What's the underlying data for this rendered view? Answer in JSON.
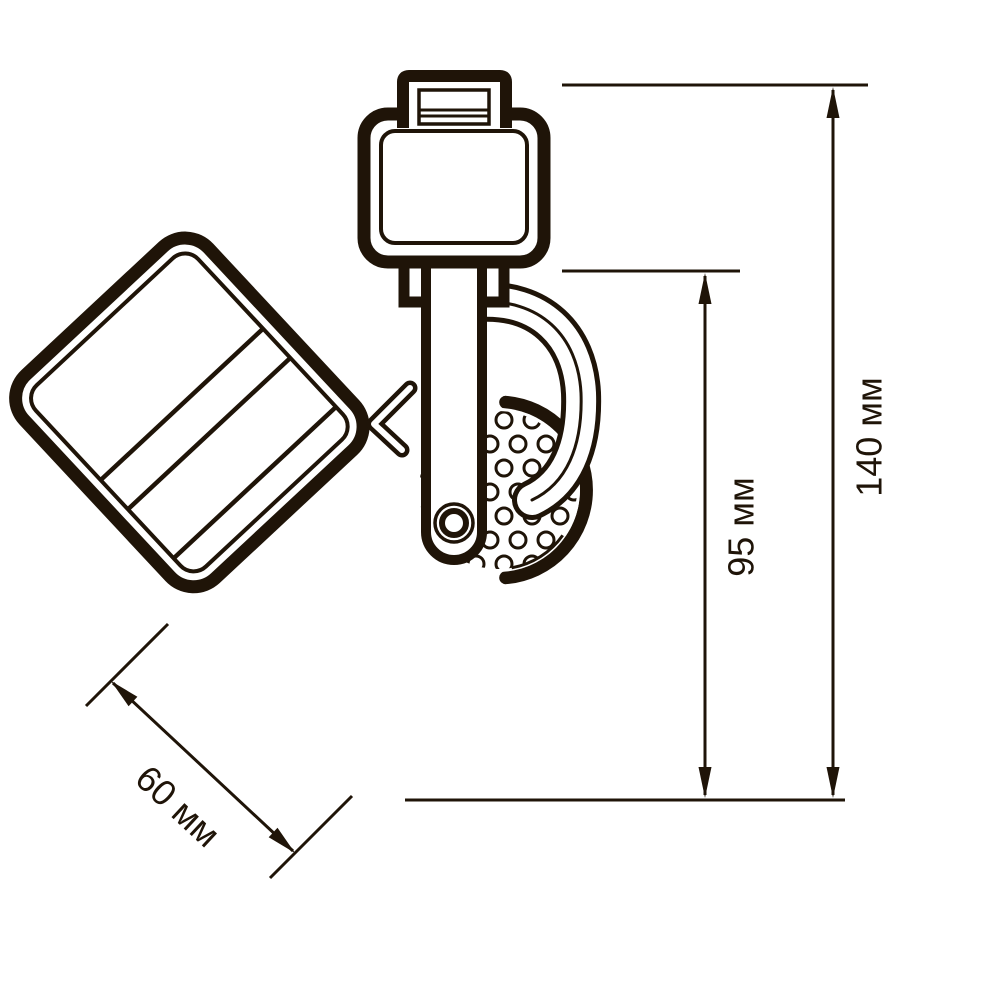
{
  "diagram": {
    "type": "technical-dimension-drawing",
    "subject": "track spotlight fixture, side view",
    "ink_color": "#1f1408",
    "background_color": "#ffffff",
    "dimensions": [
      {
        "id": "total-height",
        "label": "140 мм",
        "value": 140,
        "unit": "мм",
        "orientation": "vertical"
      },
      {
        "id": "body-height",
        "label": "95 мм",
        "value": 95,
        "unit": "мм",
        "orientation": "vertical"
      },
      {
        "id": "face-width",
        "label": "60 мм",
        "value": 60,
        "unit": "мм",
        "orientation": "diagonal"
      }
    ]
  }
}
